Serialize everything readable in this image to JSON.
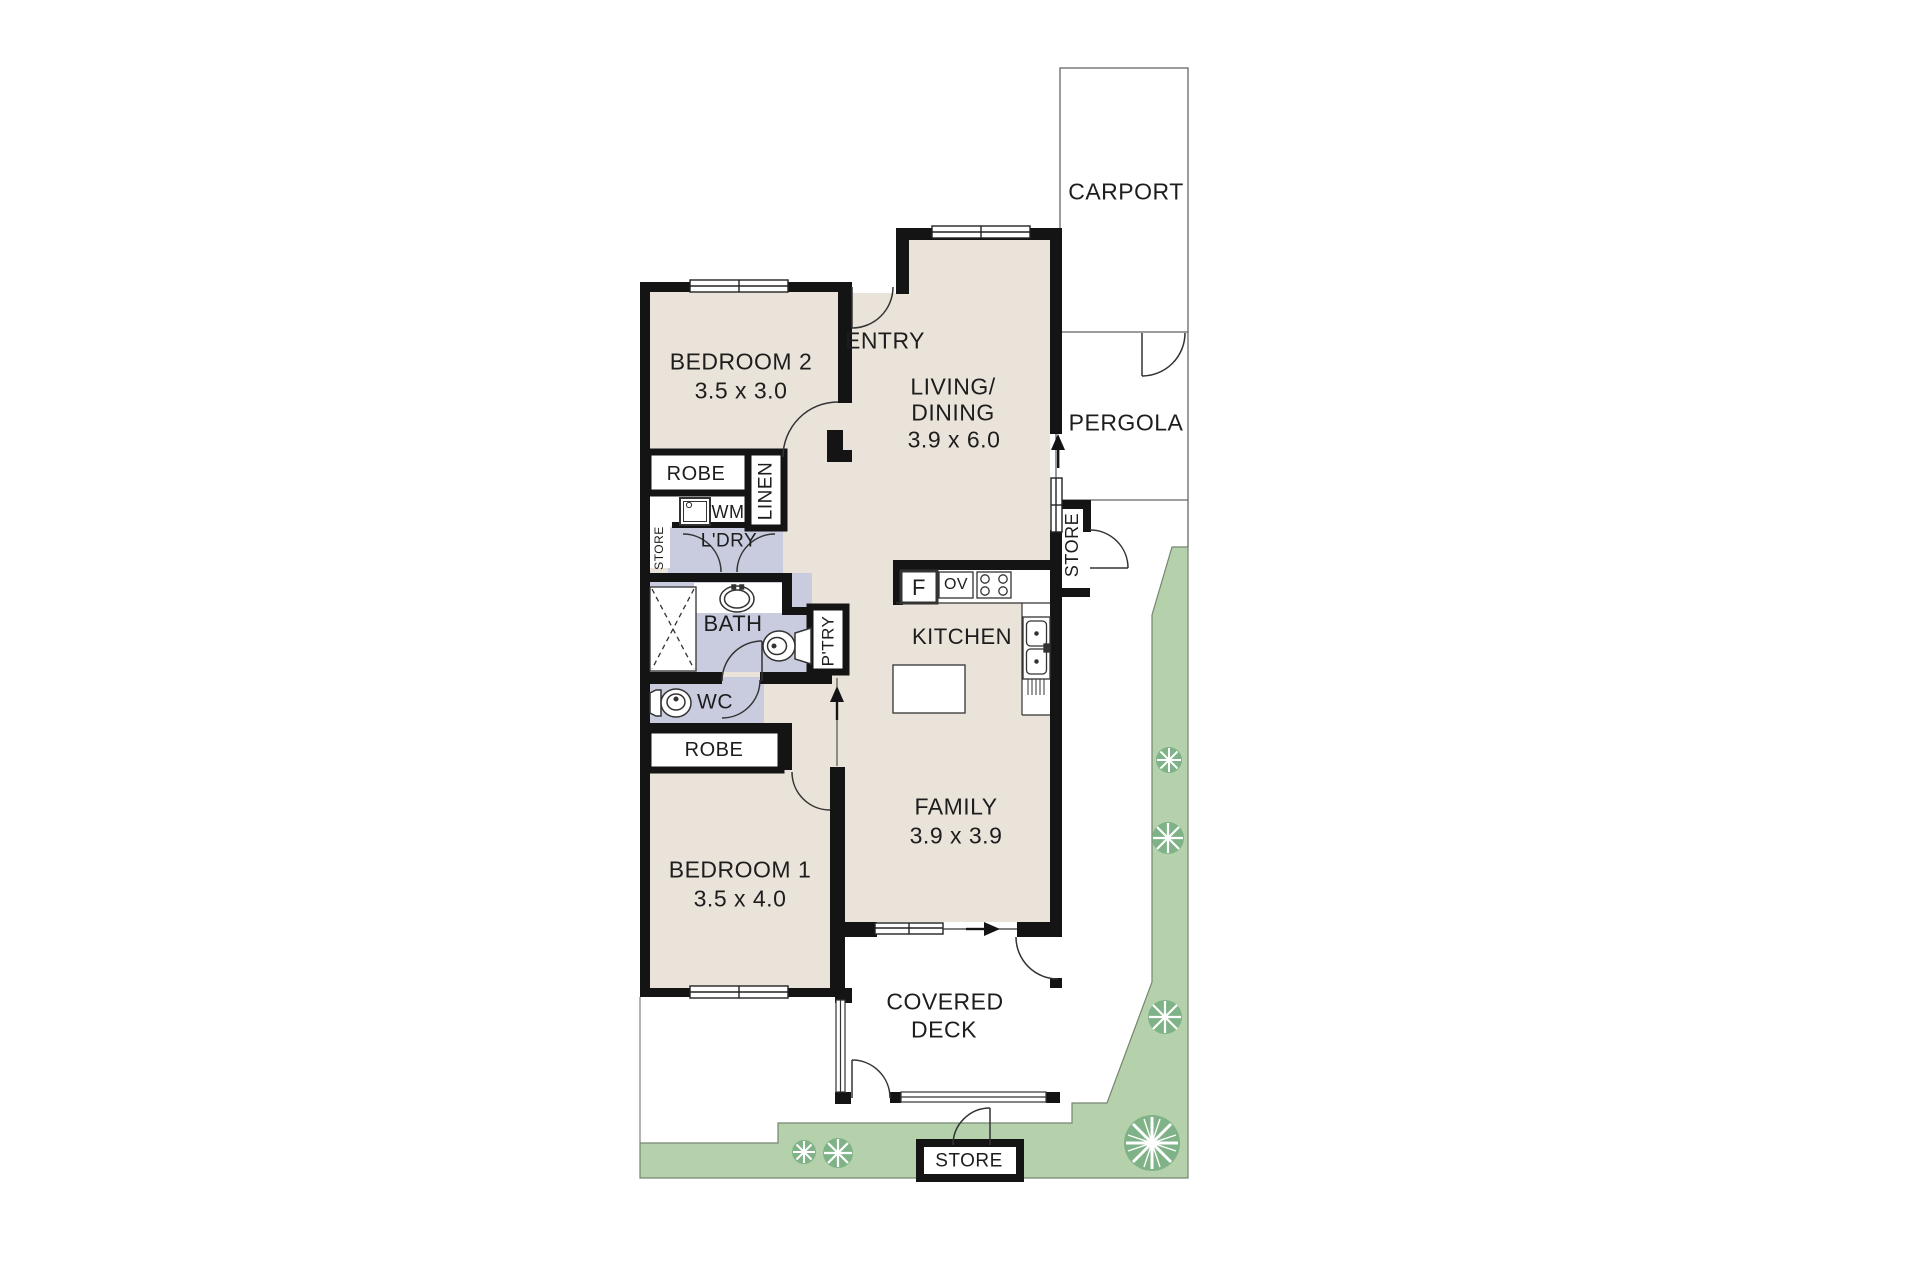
{
  "rooms": {
    "carport": "CARPORT",
    "pergola": "PERGOLA",
    "entry": "ENTRY",
    "living_line1": "LIVING/",
    "living_line2": "DINING",
    "living_dim": "3.9 x 6.0",
    "bedroom2": "BEDROOM 2",
    "bedroom2_dim": "3.5 x 3.0",
    "robe_bed2": "ROBE",
    "linen": "LINEN",
    "wm": "WM",
    "laundry": "L'DRY",
    "laundry_store": "STORE",
    "bath": "BATH",
    "pantry": "P'TRY",
    "kitchen": "KITCHEN",
    "external_store": "STORE",
    "wc": "WC",
    "robe_bed1": "ROBE",
    "bedroom1": "BEDROOM 1",
    "bedroom1_dim": "3.5 x 4.0",
    "family": "FAMILY",
    "family_dim": "3.9 x 3.9",
    "deck_line1": "COVERED",
    "deck_line2": "DECK",
    "garden_store": "STORE",
    "fridge": "F",
    "oven": "OV"
  },
  "colors": {
    "floor": "#eae3da",
    "wet": "#c9ccdf",
    "garden": "#b5d1ab",
    "plant": "#7fb287",
    "wall": "#141414",
    "line": "#333333",
    "boundary": "#76866f",
    "text": "#1d1d1d"
  }
}
